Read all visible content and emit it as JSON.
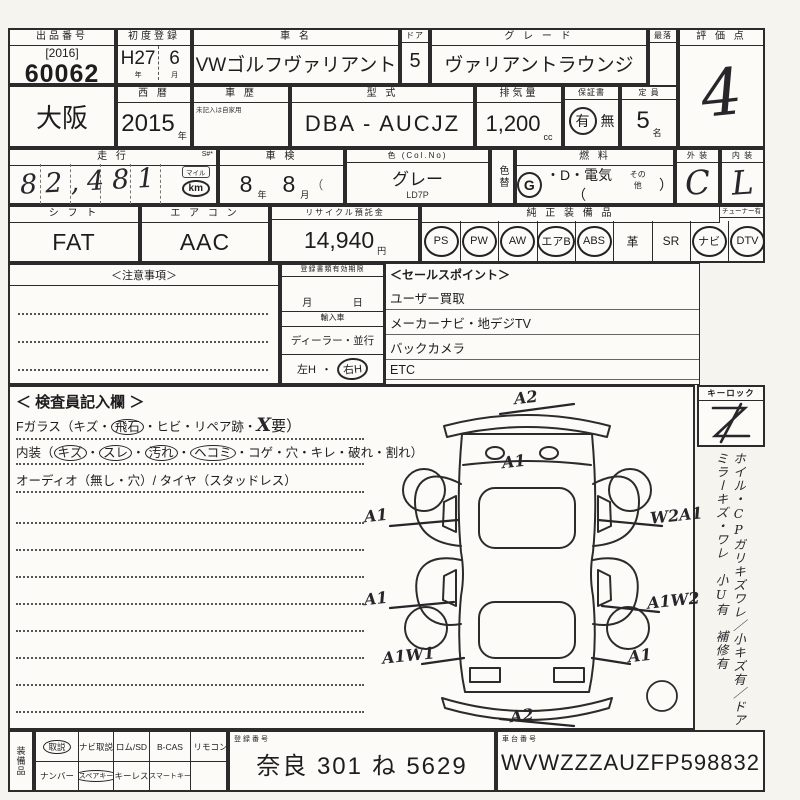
{
  "meta": {
    "paper_color": "#fcfbf7",
    "ink_color": "#2b2b2b",
    "hand_color": "#26262b"
  },
  "auction": {
    "label": "出品番号",
    "bracket_year": "[2016]",
    "number": "60062"
  },
  "first_reg": {
    "label": "初度登録",
    "era": "H27",
    "month": "6",
    "era_unit": "年",
    "month_unit": "月"
  },
  "car_name": {
    "label": "車  名",
    "value": "VWゴルフヴァリアント"
  },
  "door": {
    "label": "ドア",
    "value": "5"
  },
  "grade": {
    "label": "グ レ ー ド",
    "value": "ヴァリアントラウンジ"
  },
  "reserve": {
    "label": "最落"
  },
  "score": {
    "label": "評 価 点",
    "value": "4"
  },
  "region": {
    "value": "大阪"
  },
  "west_year": {
    "label": "西  暦",
    "value": "2015",
    "unit": "年"
  },
  "history": {
    "label": "車  歴",
    "note": "未記入は自家用"
  },
  "model": {
    "label": "型  式",
    "value": "DBA - AUCJZ"
  },
  "displacement": {
    "label": "排気量",
    "value": "1,200",
    "unit": "cc"
  },
  "warranty": {
    "label": "保証書",
    "yes": "有",
    "no": "無"
  },
  "capacity": {
    "label": "定  員",
    "value": "5",
    "unit": "名"
  },
  "mileage": {
    "label": "走  行",
    "marker": "S#*",
    "value": "82,481",
    "unit_top": "マイル",
    "unit": "km"
  },
  "inspection": {
    "label": "車  検",
    "year": "8",
    "year_unit": "年",
    "month": "8",
    "month_unit": "月",
    "paren": "（"
  },
  "color": {
    "label": "色 (Col.No)",
    "value": "グレー",
    "code": "LD7P"
  },
  "color_change": {
    "label": "色替"
  },
  "fuel": {
    "label": "燃  料",
    "g": "G",
    "mid": "・D・電気（",
    "other": "その他",
    "close": "）"
  },
  "exterior": {
    "label": "外 装",
    "value": "C"
  },
  "interior_grade": {
    "label": "内 装",
    "value": "L"
  },
  "shift": {
    "label": "シ フ ト",
    "value": "FAT"
  },
  "aircon": {
    "label": "エ ア コ ン",
    "value": "AAC"
  },
  "recycle": {
    "label": "リサイクル預託金",
    "value": "14,940",
    "unit": "円"
  },
  "equipment": {
    "label": "純 正 装 備 品",
    "tuner": "チューナー有",
    "items": [
      {
        "t": "PS",
        "ring": "eqr"
      },
      {
        "t": "PW",
        "ring": "eqr"
      },
      {
        "t": "AW",
        "ring": "eqr"
      },
      {
        "t": "エアB",
        "ring": "eqr"
      },
      {
        "t": "ABS",
        "ring": "eqr"
      },
      {
        "t": "革",
        "ring": "eqp"
      },
      {
        "t": "SR",
        "ring": "eqp"
      },
      {
        "t": "ナビ",
        "ring": "eqr"
      },
      {
        "t": "DTV",
        "ring": "eqr"
      }
    ]
  },
  "notes": {
    "title": "＜注意事項＞"
  },
  "docs": {
    "title": "登録書類有効期限",
    "month": "月",
    "day": "日",
    "import_label": "輸入車",
    "dealer": "ディーラー・並行",
    "lh": "左H",
    "sep": "・",
    "rh": "右H"
  },
  "sales": {
    "title": "＜セールスポイント＞",
    "items": [
      "ユーザー買取",
      "メーカーナビ・地デジTV",
      "バックカメラ",
      "ETC",
      "アダプティブクルーズコントロール"
    ]
  },
  "inspector": {
    "title": "＜ 検査員記入欄 ＞",
    "fglass_pre": "Fガラス（キズ・",
    "fglass_ring": "飛石",
    "fglass_mid": "・ヒビ・リペア跡・",
    "fglass_hand": "X",
    "fglass_post": "要）",
    "int_label": "内装（",
    "dot": "・",
    "c1": "キズ",
    "c2": "スレ",
    "c3": "汚れ",
    "c4": "ヘコミ",
    "int_rest": "・コゲ・穴・キレ・破れ・割れ）",
    "audio": "オーディオ（無し・穴）/ タイヤ（スタッドレス）"
  },
  "keylock": {
    "label": "キーロック"
  },
  "side_note": {
    "text": "ホイル・CPガリキズワレ／小キズ有／ドアミラーキズ・ワレ　小U有　補修有"
  },
  "diagram": {
    "marks": [
      "A2",
      "A1",
      "A1",
      "W2A1",
      "A1",
      "A1W2",
      "A1W1",
      "A1",
      "A2"
    ]
  },
  "accessories": {
    "label": "装備品",
    "row1": [
      {
        "t": "取説",
        "ring": "accr"
      },
      {
        "t": "ナビ取説",
        "ring": "accp"
      },
      {
        "t": "ロム/SD",
        "ring": "accp"
      },
      {
        "t": "B-CAS",
        "ring": "accp"
      },
      {
        "t": "リモコン",
        "ring": "accp"
      }
    ],
    "row2": [
      {
        "t": "ナンバー",
        "ring": "accp"
      },
      {
        "t": "スペアキー",
        "ring": "accr"
      },
      {
        "t": "キーレス",
        "ring": "accp"
      },
      {
        "t": "スマートキー",
        "ring": "accp"
      }
    ]
  },
  "reg_no": {
    "label": "登録番号",
    "value": "奈良 301 ね 5629"
  },
  "chassis": {
    "label": "車台番号",
    "value": "WVWZZZAUZFP598832"
  }
}
